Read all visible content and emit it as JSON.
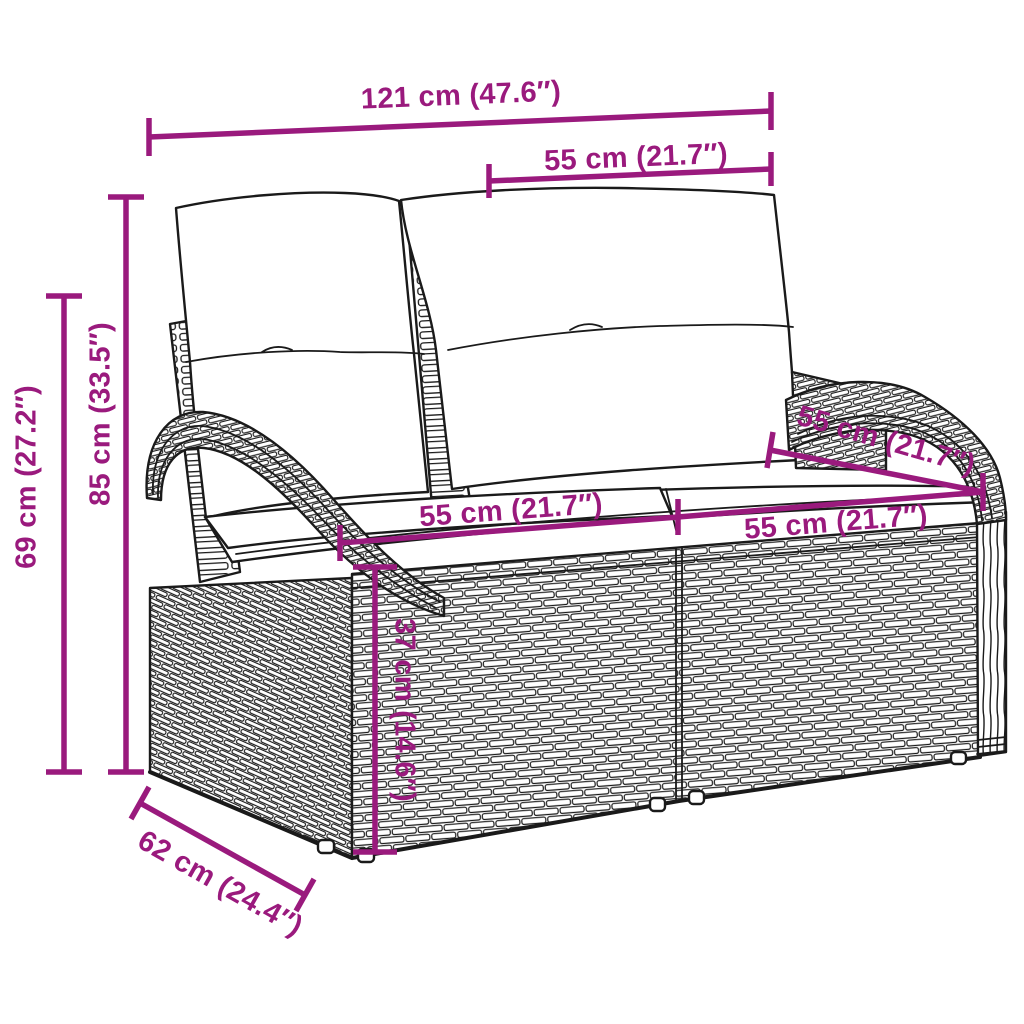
{
  "colors": {
    "accent": "#9a1a7d",
    "outline": "#1a1a1a",
    "background": "#ffffff"
  },
  "illustration": {
    "name": "wicker-rattan-2-seater-garden-bench-with-cushions"
  },
  "dims": {
    "overall_width": "121 cm (47.6″)",
    "backrest_width": "55 cm (21.7″)",
    "total_height": "85 cm (33.5″)",
    "arm_height": "69 cm (27.2″)",
    "seat_width_left": "55 cm (21.7″)",
    "seat_width_right": "55 cm (21.7″)",
    "seat_depth": "55 cm (21.7″)",
    "seat_height": "37 cm (14.6″)",
    "base_depth": "62 cm (24.4″)"
  }
}
